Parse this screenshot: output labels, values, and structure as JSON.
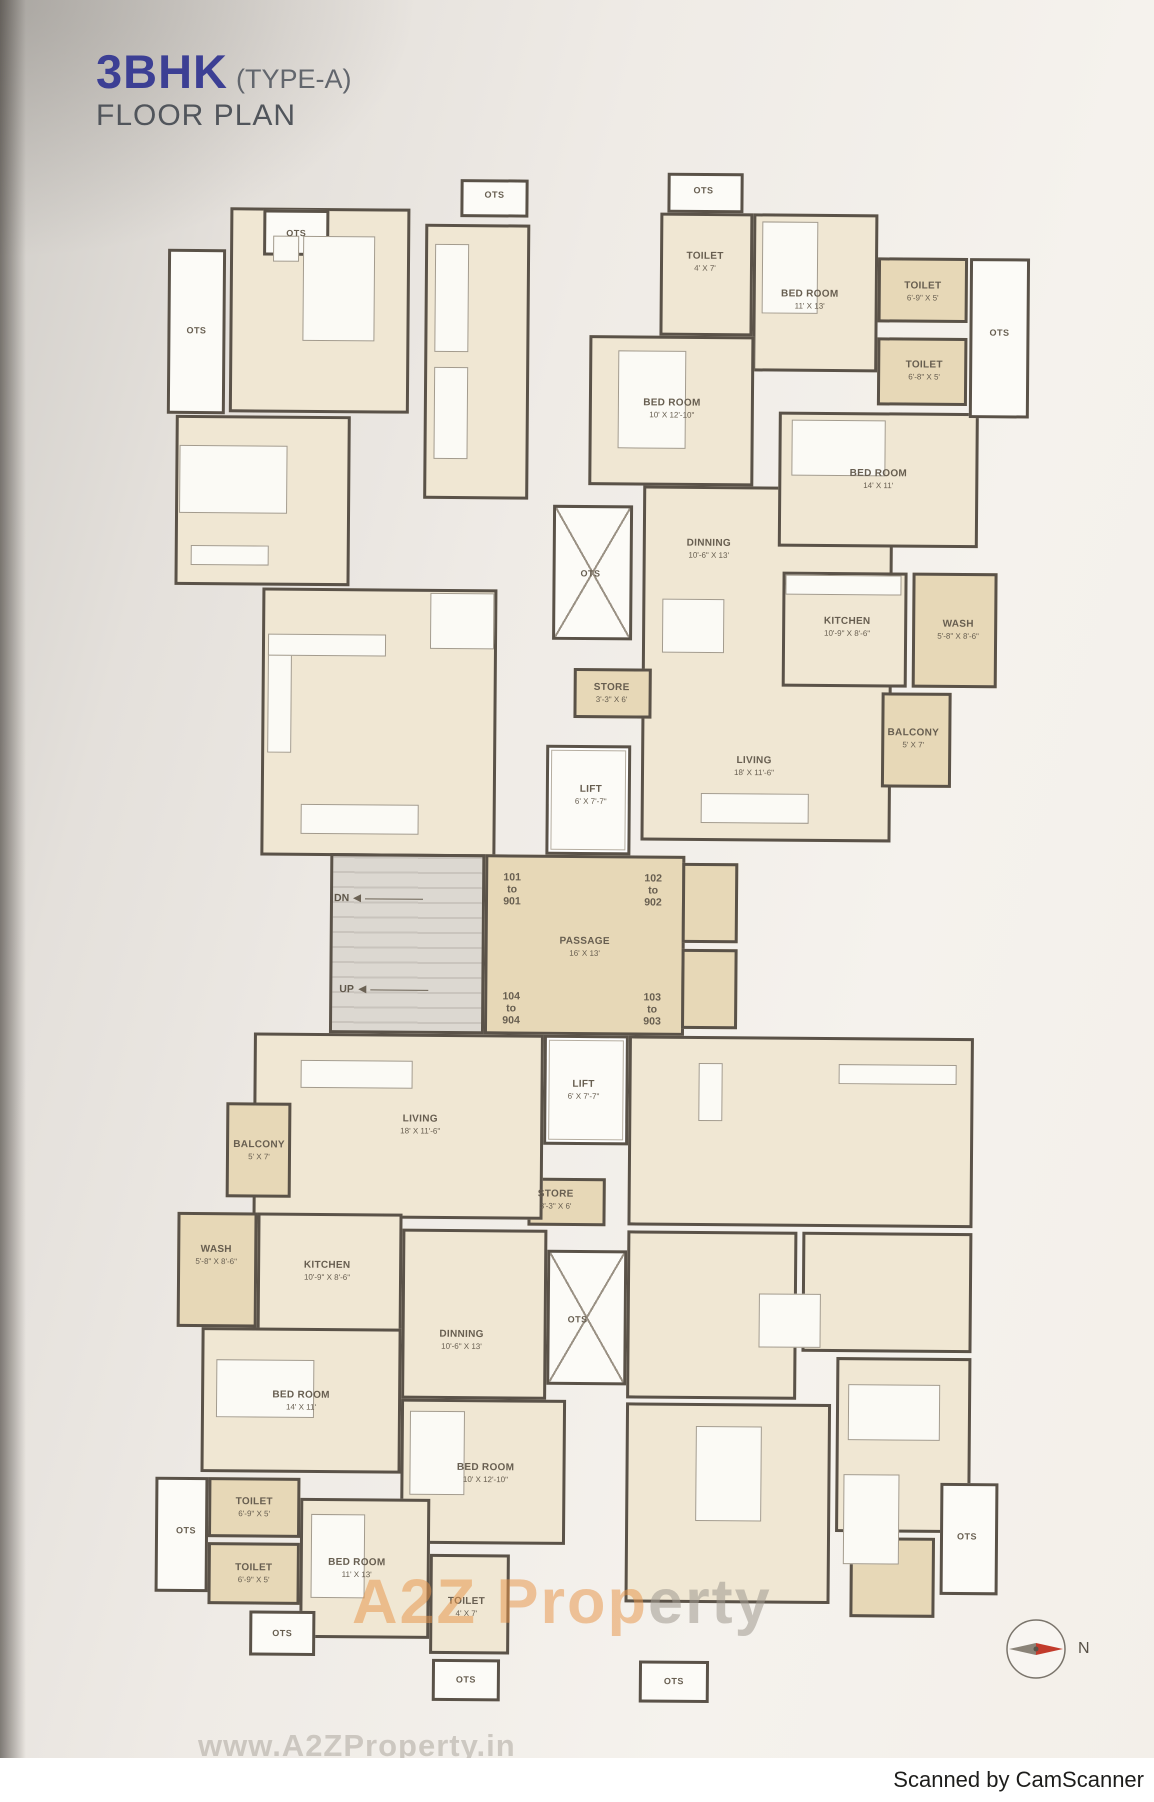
{
  "title": {
    "main": "3BHK",
    "type": "(TYPE-A)",
    "subtitle": "FLOOR PLAN"
  },
  "watermark": {
    "part1": "A2Z Prop",
    "part2": "erty",
    "url": "www.A2ZProperty.in"
  },
  "footer": {
    "scanned_by": "Scanned by CamScanner"
  },
  "compass": {
    "label": "N"
  },
  "colors": {
    "title_blue": "#3c3f94",
    "text": "#675e50",
    "wall": "#5a5248",
    "room_cream": "#f0e7d3",
    "service_tan": "#e7d8b7",
    "shaft_white": "#fcfbf7",
    "stairs_gray": "#dcd8d1",
    "watermark_orange": "#e8964a",
    "watermark_gray": "#a09a90",
    "compass_red": "#c23b2c"
  },
  "plan": {
    "blocks": [
      [
        225,
        210,
        180,
        205,
        "cream"
      ],
      [
        420,
        225,
        105,
        275,
        "cream"
      ],
      [
        172,
        418,
        175,
        170,
        "cream"
      ],
      [
        260,
        590,
        235,
        268,
        "cream"
      ],
      [
        640,
        485,
        250,
        355,
        "cream"
      ],
      [
        655,
        212,
        93,
        123,
        "cream"
      ],
      [
        748,
        212,
        125,
        158,
        "cream"
      ],
      [
        585,
        335,
        165,
        150,
        "cream"
      ],
      [
        775,
        410,
        200,
        135,
        "cream"
      ],
      [
        780,
        570,
        125,
        115,
        "cream"
      ],
      [
        910,
        570,
        85,
        115,
        "tan"
      ],
      [
        880,
        690,
        70,
        95,
        "tan"
      ],
      [
        873,
        255,
        90,
        65,
        "tan"
      ],
      [
        873,
        335,
        90,
        68,
        "tan"
      ],
      [
        965,
        255,
        60,
        160,
        "white"
      ],
      [
        258,
        212,
        66,
        46,
        "white"
      ],
      [
        163,
        252,
        58,
        165,
        "white"
      ],
      [
        455,
        180,
        68,
        38,
        "white"
      ],
      [
        662,
        172,
        76,
        40,
        "white"
      ],
      [
        550,
        505,
        80,
        135,
        "xbox"
      ],
      [
        572,
        668,
        78,
        50,
        "tan"
      ],
      [
        545,
        745,
        85,
        110,
        "lift"
      ],
      [
        330,
        855,
        155,
        180,
        "gray"
      ],
      [
        485,
        855,
        200,
        180,
        "tan"
      ],
      [
        682,
        862,
        56,
        80,
        "tan"
      ],
      [
        682,
        948,
        56,
        80,
        "tan"
      ],
      [
        545,
        1035,
        85,
        110,
        "lift"
      ],
      [
        530,
        1178,
        78,
        48,
        "tan"
      ],
      [
        550,
        1250,
        80,
        135,
        "xbox"
      ],
      [
        255,
        1035,
        290,
        185,
        "cream"
      ],
      [
        228,
        1105,
        65,
        95,
        "tan"
      ],
      [
        180,
        1215,
        80,
        115,
        "tan"
      ],
      [
        260,
        1215,
        145,
        120,
        "cream"
      ],
      [
        405,
        1230,
        145,
        170,
        "cream"
      ],
      [
        205,
        1330,
        200,
        145,
        "cream"
      ],
      [
        405,
        1400,
        165,
        145,
        "cream"
      ],
      [
        213,
        1480,
        92,
        60,
        "tan"
      ],
      [
        160,
        1480,
        53,
        115,
        "white"
      ],
      [
        213,
        1545,
        92,
        62,
        "tan"
      ],
      [
        305,
        1500,
        130,
        140,
        "cream"
      ],
      [
        435,
        1555,
        80,
        100,
        "cream"
      ],
      [
        255,
        1613,
        66,
        45,
        "white"
      ],
      [
        438,
        1660,
        68,
        42,
        "white"
      ],
      [
        630,
        1035,
        345,
        190,
        "cream"
      ],
      [
        630,
        1230,
        170,
        168,
        "cream"
      ],
      [
        805,
        1230,
        170,
        120,
        "cream"
      ],
      [
        630,
        1402,
        205,
        200,
        "cream"
      ],
      [
        840,
        1355,
        135,
        175,
        "cream"
      ],
      [
        855,
        1535,
        85,
        80,
        "tan"
      ],
      [
        945,
        1480,
        58,
        112,
        "white"
      ],
      [
        645,
        1660,
        70,
        42,
        "white"
      ]
    ],
    "furniture": [
      [
        298,
        238,
        72,
        105
      ],
      [
        268,
        238,
        26,
        26
      ],
      [
        176,
        448,
        108,
        68
      ],
      [
        188,
        548,
        78,
        20
      ],
      [
        430,
        245,
        34,
        108
      ],
      [
        430,
        368,
        34,
        92
      ],
      [
        266,
        640,
        24,
        115
      ],
      [
        266,
        636,
        118,
        22
      ],
      [
        300,
        806,
        118,
        30
      ],
      [
        428,
        594,
        64,
        56
      ],
      [
        757,
        220,
        56,
        92
      ],
      [
        614,
        350,
        68,
        98
      ],
      [
        788,
        418,
        94,
        56
      ],
      [
        783,
        573,
        116,
        20
      ],
      [
        660,
        598,
        62,
        54
      ],
      [
        700,
        792,
        108,
        30
      ],
      [
        840,
        1062,
        118,
        20
      ],
      [
        700,
        1062,
        24,
        58
      ],
      [
        762,
        1292,
        62,
        54
      ],
      [
        700,
        1425,
        66,
        95
      ],
      [
        852,
        1382,
        92,
        56
      ],
      [
        316,
        1516,
        54,
        84
      ],
      [
        414,
        1412,
        55,
        84
      ],
      [
        220,
        1362,
        98,
        58
      ],
      [
        302,
        1062,
        112,
        28
      ],
      [
        848,
        1472,
        56,
        90
      ]
    ],
    "labels": [
      {
        "x": 291,
        "y": 236,
        "kind": "ots",
        "lines": [
          "OTS"
        ]
      },
      {
        "x": 192,
        "y": 334,
        "kind": "ots",
        "lines": [
          "OTS"
        ]
      },
      {
        "x": 489,
        "y": 196,
        "kind": "ots",
        "lines": [
          "OTS"
        ]
      },
      {
        "x": 698,
        "y": 190,
        "kind": "ots",
        "lines": [
          "OTS"
        ]
      },
      {
        "x": 700,
        "y": 261,
        "kind": "room",
        "lines": [
          "TOILET",
          "4' X 7'"
        ]
      },
      {
        "x": 805,
        "y": 298,
        "kind": "room",
        "lines": [
          "BED ROOM",
          "11' X 13'"
        ]
      },
      {
        "x": 918,
        "y": 289,
        "kind": "room",
        "lines": [
          "TOILET",
          "6'-9\" X 5'"
        ]
      },
      {
        "x": 995,
        "y": 330,
        "kind": "ots",
        "lines": [
          "OTS"
        ]
      },
      {
        "x": 920,
        "y": 368,
        "kind": "room",
        "lines": [
          "TOILET",
          "6'-8\" X 5'"
        ]
      },
      {
        "x": 668,
        "y": 408,
        "kind": "room",
        "lines": [
          "BED ROOM",
          "10' X 12'-10\""
        ]
      },
      {
        "x": 875,
        "y": 477,
        "kind": "room",
        "lines": [
          "BED ROOM",
          "14' X 11'"
        ]
      },
      {
        "x": 706,
        "y": 548,
        "kind": "room",
        "lines": [
          "DINNING",
          "10'-6\" X 13'"
        ]
      },
      {
        "x": 588,
        "y": 574,
        "kind": "ots",
        "lines": [
          "OTS"
        ]
      },
      {
        "x": 845,
        "y": 625,
        "kind": "room",
        "lines": [
          "KITCHEN",
          "10'-9\" X 8'-6\""
        ]
      },
      {
        "x": 956,
        "y": 627,
        "kind": "room",
        "lines": [
          "WASH",
          "5'-8\" X 8'-6\""
        ]
      },
      {
        "x": 610,
        "y": 693,
        "kind": "room",
        "lines": [
          "STORE",
          "3'-3\" X 6'"
        ]
      },
      {
        "x": 912,
        "y": 736,
        "kind": "room",
        "lines": [
          "BALCONY",
          "5' X 7'"
        ]
      },
      {
        "x": 753,
        "y": 765,
        "kind": "room",
        "lines": [
          "LIVING",
          "18' X 11'-6\""
        ]
      },
      {
        "x": 590,
        "y": 795,
        "kind": "room",
        "lines": [
          "LIFT",
          "6' X 7'-7\""
        ]
      },
      {
        "x": 512,
        "y": 890,
        "kind": "unit",
        "lines": [
          "101",
          "to",
          "901"
        ]
      },
      {
        "x": 653,
        "y": 890,
        "kind": "unit",
        "lines": [
          "102",
          "to",
          "902"
        ]
      },
      {
        "x": 585,
        "y": 947,
        "kind": "room",
        "lines": [
          "PASSAGE",
          "16' X 13'"
        ]
      },
      {
        "x": 512,
        "y": 1009,
        "kind": "unit",
        "lines": [
          "104",
          "to",
          "904"
        ]
      },
      {
        "x": 653,
        "y": 1009,
        "kind": "unit",
        "lines": [
          "103",
          "to",
          "903"
        ]
      },
      {
        "x": 585,
        "y": 1090,
        "kind": "room",
        "lines": [
          "LIFT",
          "6' X 7'-7\""
        ]
      },
      {
        "x": 422,
        "y": 1126,
        "kind": "room",
        "lines": [
          "LIVING",
          "18' X 11'-6\""
        ]
      },
      {
        "x": 261,
        "y": 1153,
        "kind": "room",
        "lines": [
          "BALCONY",
          "5' X 7'"
        ]
      },
      {
        "x": 558,
        "y": 1200,
        "kind": "room",
        "lines": [
          "STORE",
          "3'-3\" X 6'"
        ]
      },
      {
        "x": 219,
        "y": 1258,
        "kind": "room",
        "lines": [
          "WASH",
          "5'-8\" X 8'-6\""
        ]
      },
      {
        "x": 330,
        "y": 1273,
        "kind": "room",
        "lines": [
          "KITCHEN",
          "10'-9\" X 8'-6\""
        ]
      },
      {
        "x": 581,
        "y": 1320,
        "kind": "ots",
        "lines": [
          "OTS"
        ]
      },
      {
        "x": 465,
        "y": 1341,
        "kind": "room",
        "lines": [
          "DINNING",
          "10'-6\" X 13'"
        ]
      },
      {
        "x": 305,
        "y": 1403,
        "kind": "room",
        "lines": [
          "BED ROOM",
          "14' X 11'"
        ]
      },
      {
        "x": 490,
        "y": 1474,
        "kind": "room",
        "lines": [
          "BED ROOM",
          "10' X 12'-10\""
        ]
      },
      {
        "x": 259,
        "y": 1510,
        "kind": "room",
        "lines": [
          "TOILET",
          "6'-9\" X 5'"
        ]
      },
      {
        "x": 191,
        "y": 1534,
        "kind": "ots",
        "lines": [
          "OTS"
        ]
      },
      {
        "x": 259,
        "y": 1576,
        "kind": "room",
        "lines": [
          "TOILET",
          "6'-9\" X 5'"
        ]
      },
      {
        "x": 362,
        "y": 1570,
        "kind": "room",
        "lines": [
          "BED ROOM",
          "11' X 13'"
        ]
      },
      {
        "x": 472,
        "y": 1608,
        "kind": "room",
        "lines": [
          "TOILET",
          "4' X 7'"
        ]
      },
      {
        "x": 972,
        "y": 1534,
        "kind": "ots",
        "lines": [
          "OTS"
        ]
      },
      {
        "x": 288,
        "y": 1636,
        "kind": "ots",
        "lines": [
          "OTS"
        ]
      },
      {
        "x": 472,
        "y": 1681,
        "kind": "ots",
        "lines": [
          "OTS"
        ]
      },
      {
        "x": 680,
        "y": 1681,
        "kind": "ots",
        "lines": [
          "OTS"
        ]
      }
    ],
    "stairs": [
      {
        "text": "DN",
        "left": 334,
        "top": 894
      },
      {
        "text": "UP",
        "left": 340,
        "top": 985
      }
    ]
  }
}
